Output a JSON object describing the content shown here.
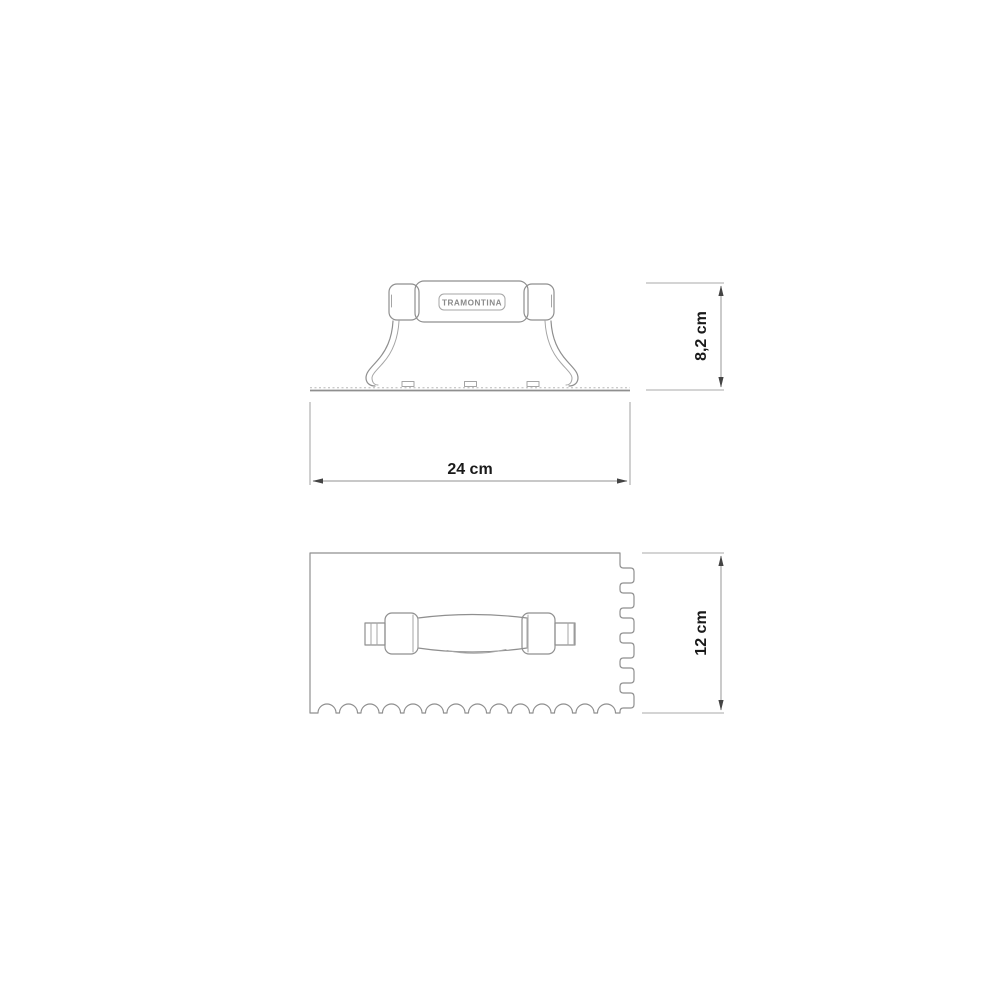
{
  "page": {
    "background": "#ffffff"
  },
  "diagram": {
    "brand_label": "TRAMONTINA",
    "dimensions": {
      "height": {
        "label": "8,2 cm"
      },
      "width": {
        "label": "24 cm"
      },
      "depth": {
        "label": "12 cm"
      }
    },
    "colors": {
      "outline": "#8f8f8f",
      "outline_thin": "#a5a5a5",
      "dimension_line": "#a8a8a8",
      "arrow": "#444444",
      "text": "#1a1a1a",
      "background": "#ffffff"
    }
  }
}
